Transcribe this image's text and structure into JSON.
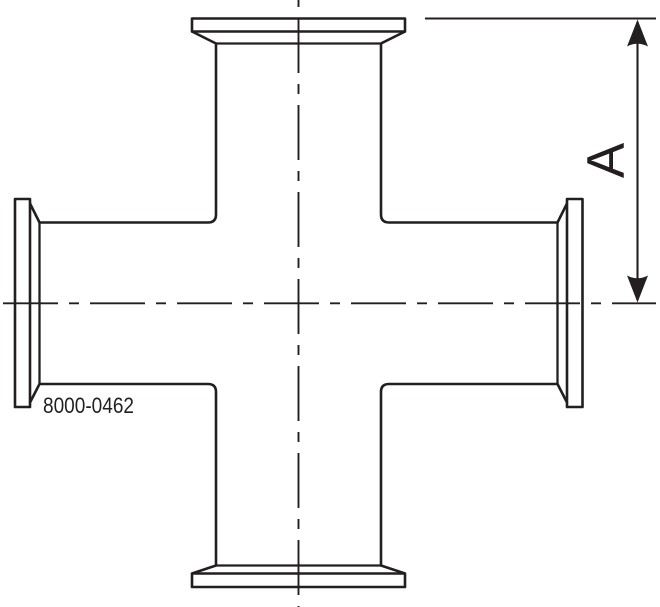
{
  "drawing": {
    "description": "Side-view engineering drawing of a four-way clamp cross fitting with flanged ferrule ends",
    "labels": {
      "dimension": "A",
      "part_number": "8000-0462"
    },
    "colors": {
      "line": "#231f20",
      "background": "#ffffff"
    }
  }
}
